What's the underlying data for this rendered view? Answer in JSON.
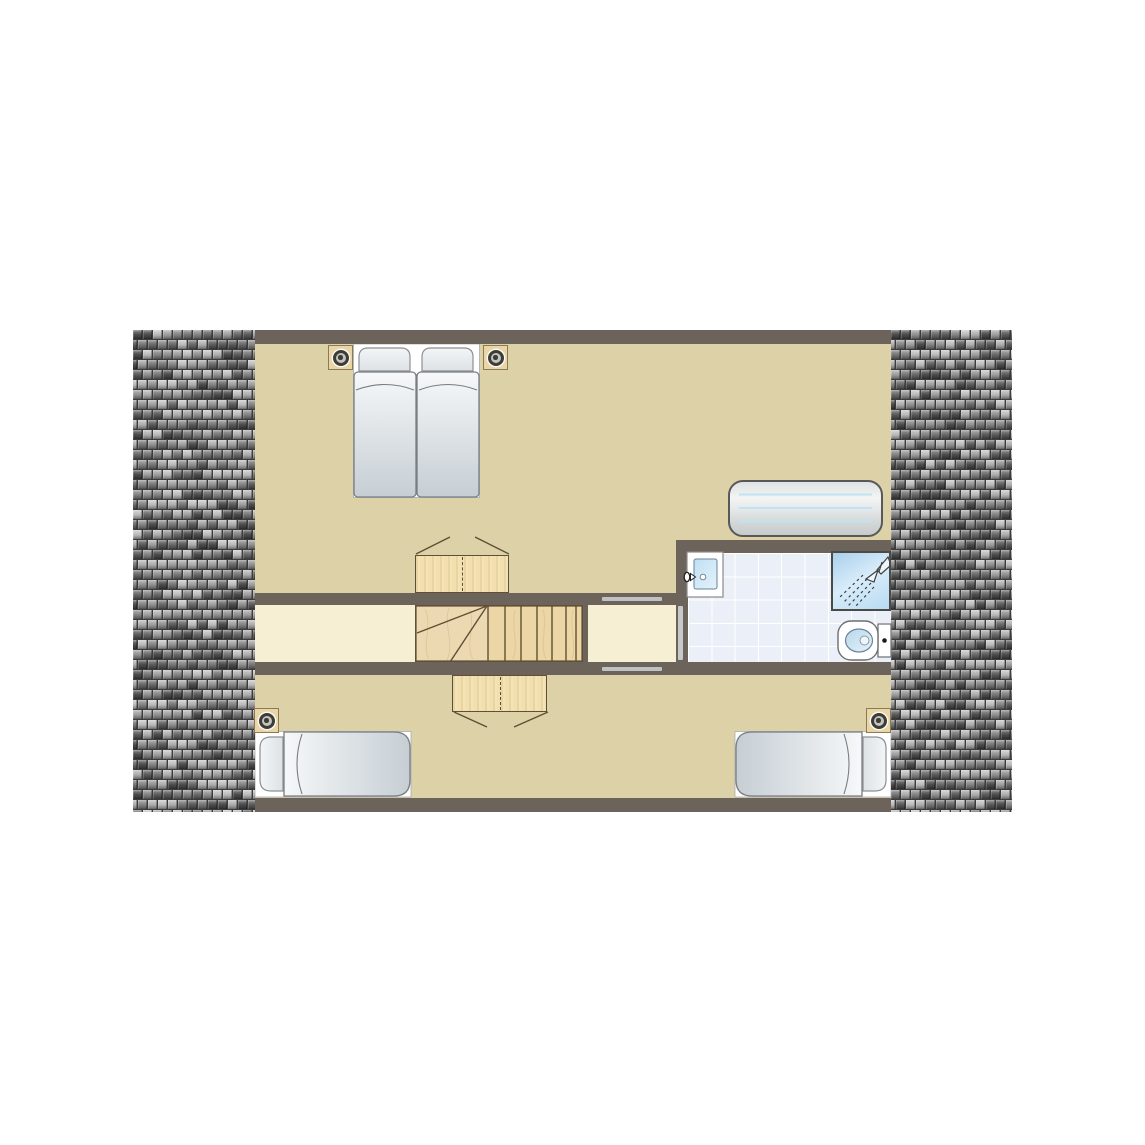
{
  "canvas": {
    "width": 1145,
    "height": 1145,
    "background": "#ffffff"
  },
  "plan": {
    "kind": "floor-plan",
    "text_labels": [],
    "rooms": [
      {
        "name": "bedroom-top",
        "items": [
          "twin-single-beds",
          "pillow",
          "pillow",
          "nightstand-with-lamp-left",
          "nightstand-with-lamp-right",
          "wardrobe-open-doors",
          "radiator"
        ]
      },
      {
        "name": "hallway",
        "items": [
          "staircase-with-winder-treads",
          "doorway-to-bedroom-top",
          "doorway-to-bedroom-bottom",
          "door-to-bathroom",
          "landing"
        ]
      },
      {
        "name": "bathroom",
        "items": [
          "washbasin-with-tap",
          "shower-with-showerhead",
          "toilet-with-cistern",
          "tiled-floor"
        ]
      },
      {
        "name": "bedroom-bottom",
        "items": [
          "single-bed-left",
          "single-bed-right",
          "nightstand-with-lamp-left",
          "nightstand-with-lamp-right",
          "wardrobe-open-doors"
        ]
      }
    ],
    "roof": [
      "shingle-strip-left",
      "shingle-strip-right"
    ]
  },
  "palette": {
    "wall": "#6c635b",
    "floor_tan": "#ddd1a7",
    "floor_corridor": "#f7efd3",
    "threshold": "#bfc1c2",
    "door_leaf": "#c6c9ca",
    "wood_front": "#f2dfae",
    "wood_outline": "#5f4f35",
    "stairs_left": "#ecd9b2",
    "stairs_right": "#ecd6a6",
    "tile_floor": "#ebeff7",
    "tile_grid": "#ffffff",
    "radiator_line": "#bfe3f0",
    "nightstand": "#e9d6a7",
    "nightstand_border": "#8c7a57",
    "lamp_ring": "#3c3c38",
    "lamp_body": "#c4c4bd",
    "mattress_light": "#f6f8f9",
    "mattress_dark": "#c6ced4",
    "mattress_outline": "#787d82",
    "basin_blue_light": "#e4f2fb",
    "basin_blue": "#b7d7eb",
    "shower_blue": "#a9cfeb",
    "shingle_gap": "#3c3c3c",
    "shingle_shades": [
      "#4c4c4c",
      "#5c5c5c",
      "#6a6a6a",
      "#787878",
      "#868686",
      "#949494",
      "#a2a2a2",
      "#b1b1b1",
      "#bfbfbf"
    ]
  }
}
